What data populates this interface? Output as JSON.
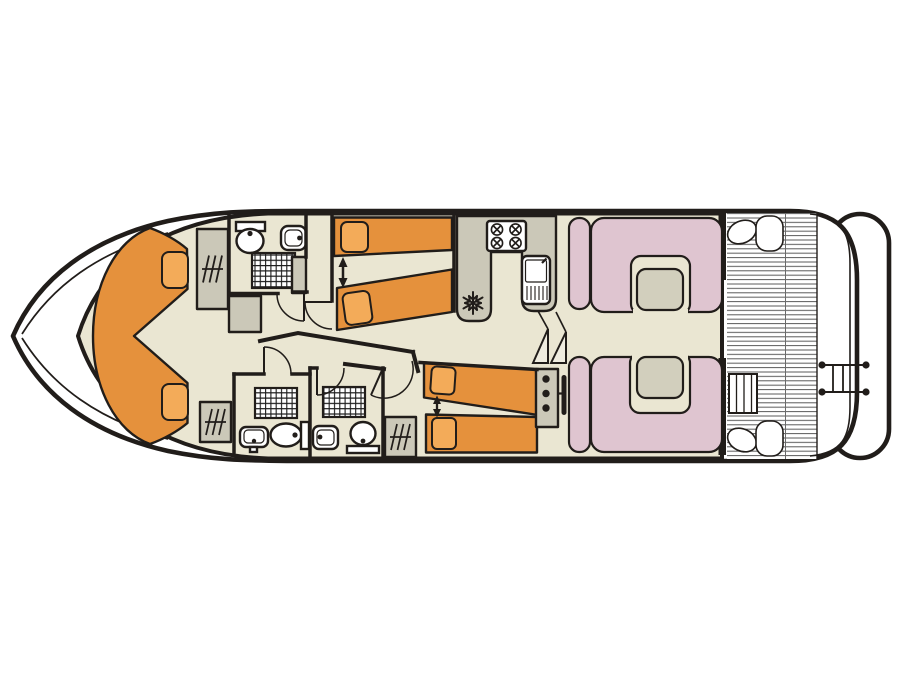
{
  "diagram": {
    "title": "Houseboat deck plan - top view interior layout, bow at left and stern at right",
    "type": "boat-floor-plan",
    "orientation": {
      "bow": "left",
      "stern": "right"
    },
    "areas": [
      {
        "id": "bow-cabin",
        "label": "Bow cabin with V-shaped double berth",
        "fixtures": [
          "v-shaped double bed",
          "2 pillows"
        ]
      },
      {
        "id": "fore-bathroom",
        "label": "Forward bathroom",
        "fixtures": [
          "toilet with cistern",
          "washbasin",
          "shower",
          "cabinet",
          "wardrobe"
        ]
      },
      {
        "id": "twin-cabin-top",
        "label": "Midship twin cabin (upper side)",
        "fixtures": [
          "2 single beds",
          "2 pillows",
          "slide-together arrow"
        ]
      },
      {
        "id": "twin-cabin-bottom",
        "label": "Midship twin cabin (lower side)",
        "fixtures": [
          "2 single beds",
          "2 pillows",
          "slide-together arrow",
          "wardrobe"
        ]
      },
      {
        "id": "aft-bathroom-left",
        "label": "Aft bathroom (left)",
        "fixtures": [
          "shower",
          "washbasin",
          "toilet with cistern"
        ]
      },
      {
        "id": "aft-bathroom-right",
        "label": "Aft bathroom (right)",
        "fixtures": [
          "shower",
          "washbasin",
          "toilet"
        ]
      },
      {
        "id": "galley",
        "label": "Galley",
        "fixtures": [
          "4-burner hob",
          "sink with drainer",
          "refrigerator (snowflake symbol)"
        ]
      },
      {
        "id": "helm",
        "label": "Helm station",
        "fixtures": [
          "instrument console with 3 gauges",
          "steering wheel",
          "companionway steps"
        ]
      },
      {
        "id": "saloon",
        "label": "Saloon / dinette",
        "fixtures": [
          "2 U-shaped upholstered benches",
          "2 tables",
          "2 side seats"
        ]
      },
      {
        "id": "aft-deck",
        "label": "Aft deck",
        "fixtures": [
          "slatted floor",
          "corner seats",
          "boarding steps",
          "stern rail with swim ladder",
          "swim platform"
        ]
      }
    ]
  },
  "symbols": [
    {
      "name": "double-arrow",
      "meaning": "single beds slide together"
    },
    {
      "name": "snowflake-icon",
      "meaning": "refrigerator"
    },
    {
      "name": "grid-square",
      "meaning": "shower tray"
    },
    {
      "name": "rail-hatch",
      "meaning": "wardrobe / hanging locker"
    },
    {
      "name": "twin-triangles",
      "meaning": "companionway steps"
    }
  ],
  "colors": {
    "outline": "#211d1a",
    "floor": "#eae6d2",
    "furniture_orange": "#e5913c",
    "pillow": "#f3ab59",
    "counter_gray": "#cbc8b8",
    "upholstery_pink": "#dfc5d0",
    "table": "#d2cfbd",
    "deck_white": "#ffffff",
    "stair": "#efecdf"
  }
}
